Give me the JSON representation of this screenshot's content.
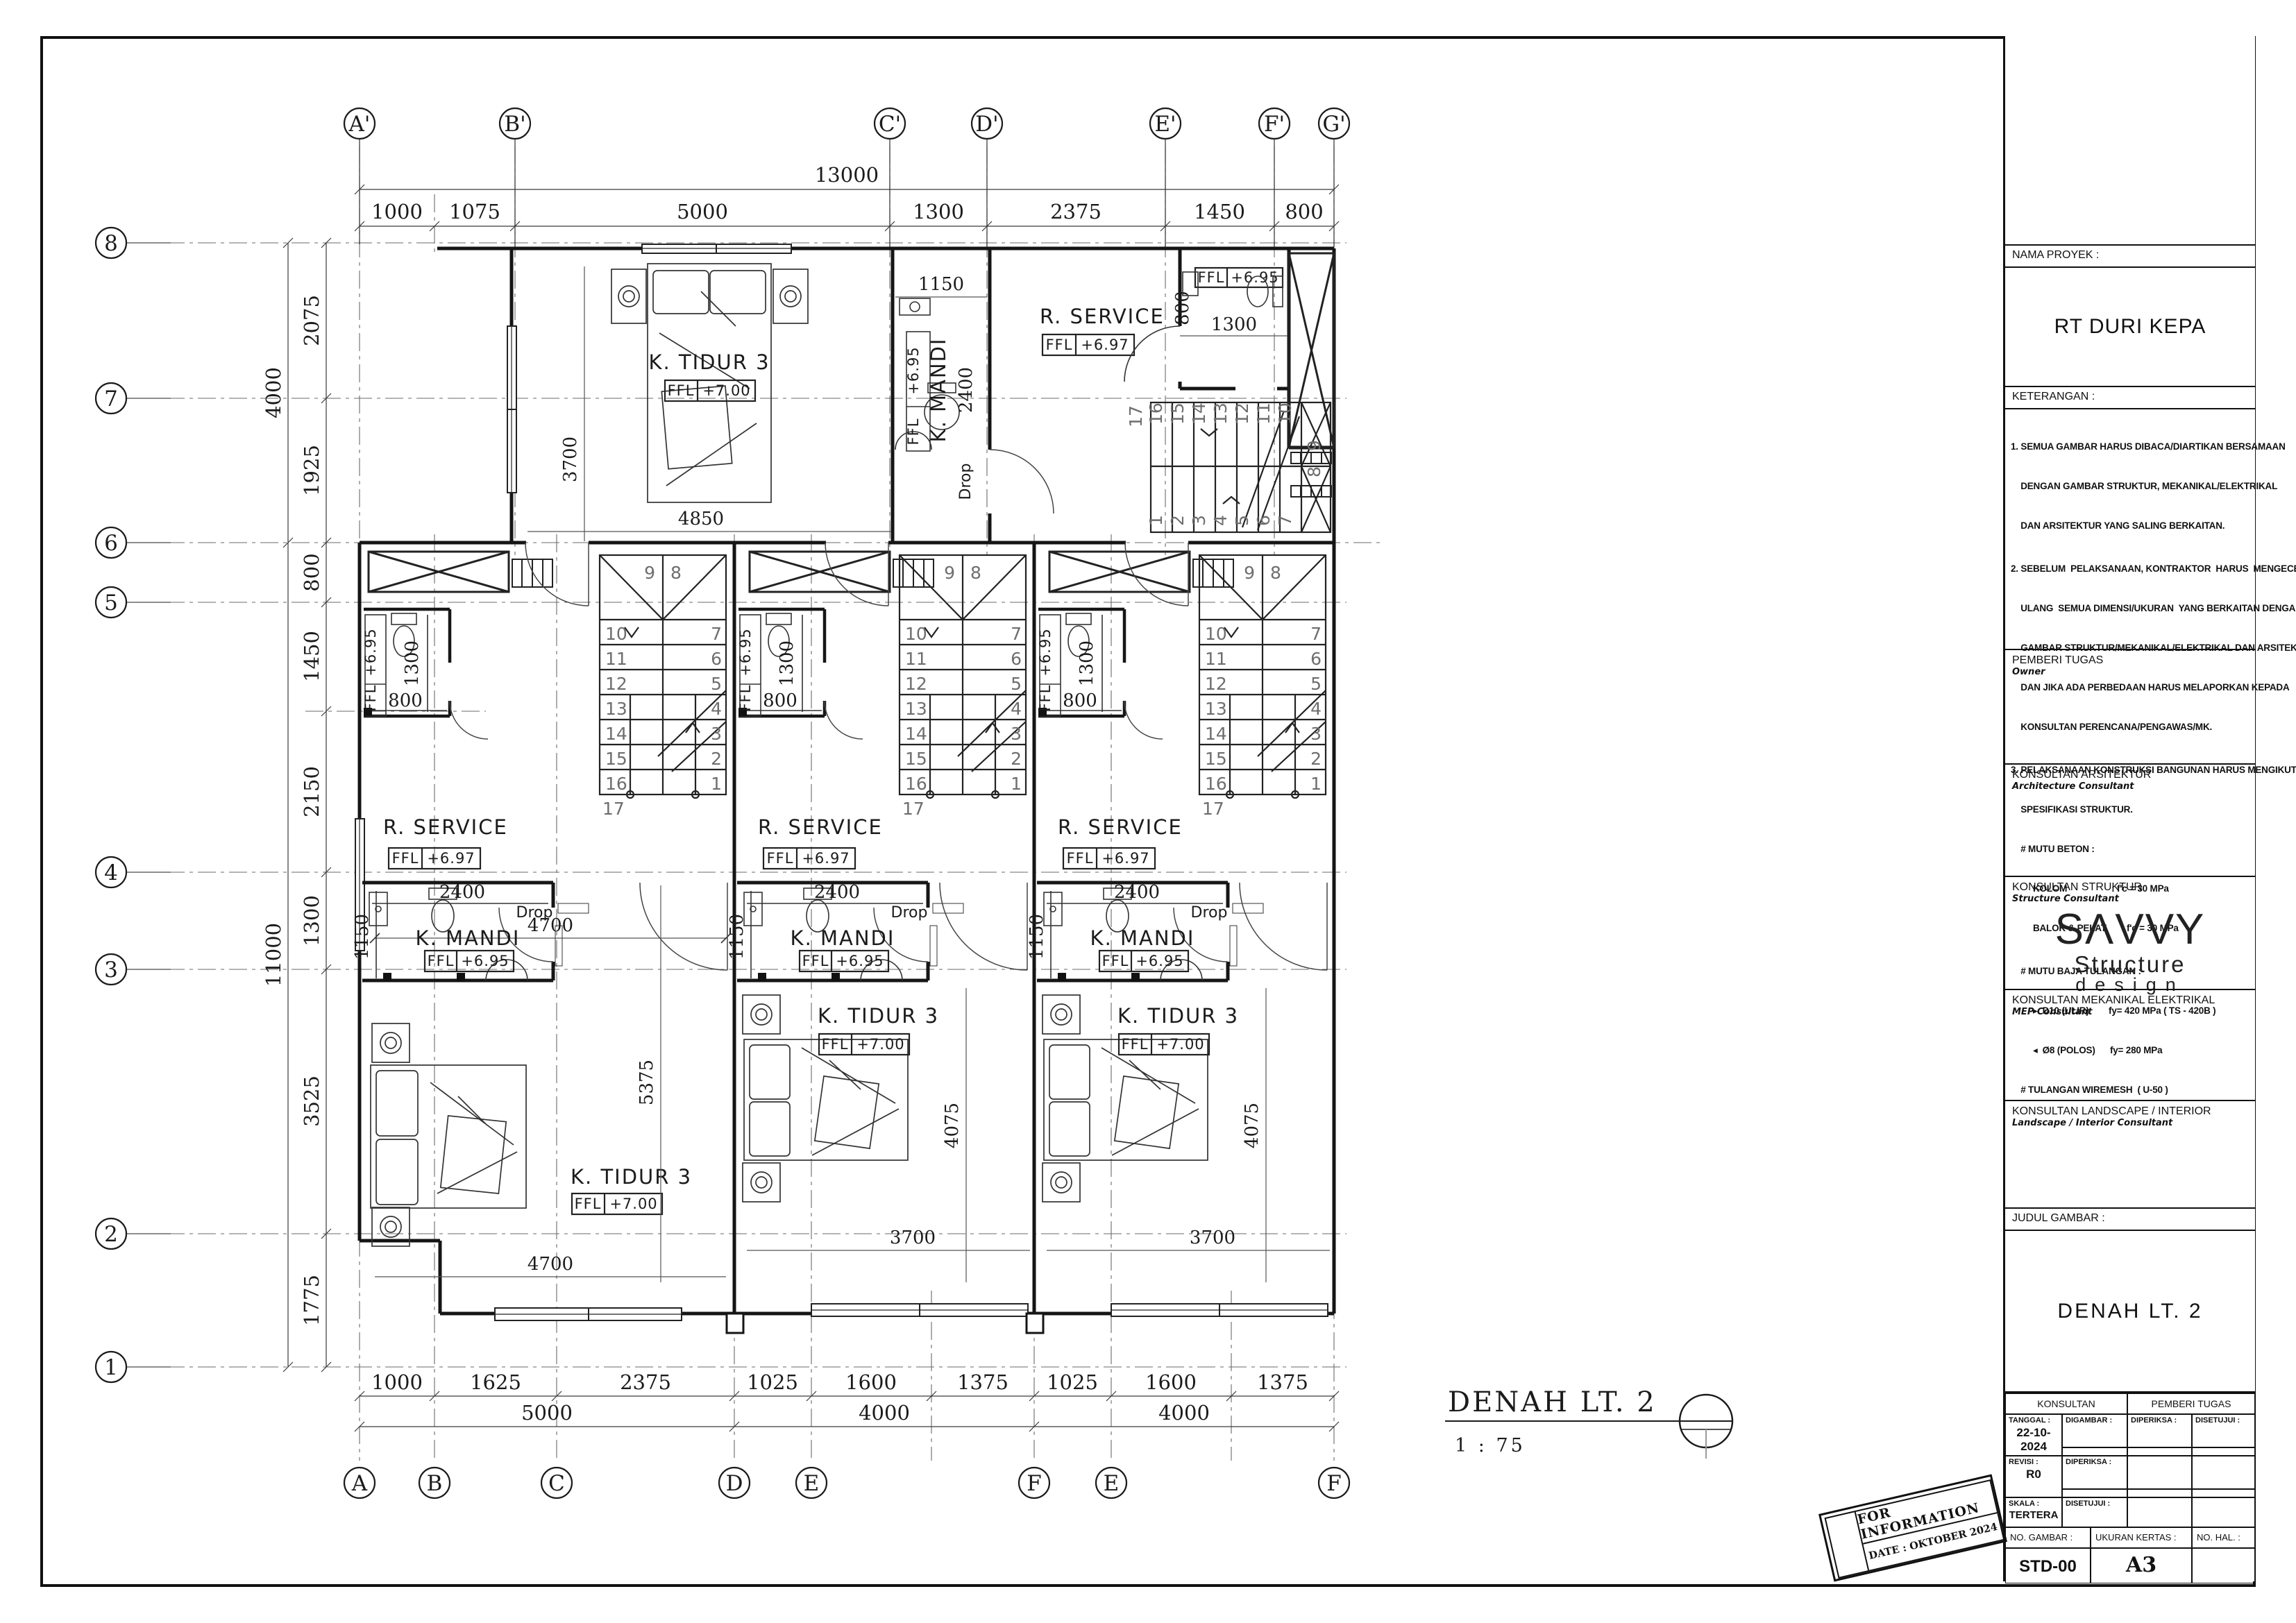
{
  "sheet": {
    "drawing_title": {
      "text": "DENAH  LT.  2",
      "scale": "1 : 75"
    },
    "stamp": {
      "line1": "FOR  INFORMATION",
      "line2": "DATE : OKTOBER 2024"
    }
  },
  "plan": {
    "grid_top": [
      "A'",
      "B'",
      "C'",
      "D'",
      "E'",
      "F'",
      "G'"
    ],
    "grid_bottom": [
      "A",
      "B",
      "C",
      "D",
      "E",
      "F",
      "E",
      "F"
    ],
    "grid_left": [
      "8",
      "7",
      "6",
      "5",
      "4",
      "3",
      "2",
      "1"
    ],
    "dims": {
      "top_total": "13000",
      "top": [
        "1000",
        "1075",
        "5000",
        "1300",
        "2375",
        "1450",
        "800"
      ],
      "left_outer": [
        "4000",
        "11000"
      ],
      "left": [
        "2075",
        "1925",
        "800",
        "1450",
        "2150",
        "1300",
        "3525",
        "1775"
      ],
      "bottom": [
        "1000",
        "1625",
        "2375",
        "1025",
        "1600",
        "1375",
        "1025",
        "1600",
        "1375"
      ],
      "bottom_totals": [
        "5000",
        "4000",
        "4000"
      ],
      "top_bed_width": "4850",
      "top_bed_depth": "3700",
      "mandi_top_width": "1150",
      "toilet_depth": "1300",
      "toilet_width": "800",
      "service_width": "4700",
      "mandi_width": "2400",
      "mandi_depth": "1150",
      "bed1_depth": "5375",
      "bed1_width": "4700",
      "bed23_depth": "4075",
      "bed23_width": "3700"
    },
    "rooms": {
      "tidur": "K. TIDUR 3",
      "mandi": "K. MANDI",
      "service": "R. SERVICE",
      "drop": "Drop"
    },
    "ffl": {
      "label": "FFL",
      "tidur": "+7.00",
      "mandi": "+6.95",
      "service": "+6.97"
    },
    "stair": {
      "landing9": "9",
      "landing8": "8",
      "last": "17",
      "upper": [
        "10",
        "11",
        "12",
        "13",
        "14",
        "15",
        "16"
      ],
      "lower": [
        "7",
        "6",
        "5",
        "4",
        "3",
        "2",
        "1"
      ]
    }
  },
  "title_block": {
    "nama_proyek_label": "NAMA PROYEK :",
    "project_name": "RT DURI KEPA",
    "keterangan_label": "KETERANGAN :",
    "notes": [
      "1. SEMUA GAMBAR HARUS DIBACA/DIARTIKAN BERSAMAAN",
      "    DENGAN GAMBAR STRUKTUR, MEKANIKAL/ELEKTRIKAL",
      "    DAN ARSITEKTUR YANG SALING BERKAITAN.",
      "2. SEBELUM  PELAKSANAAN, KONTRAKTOR  HARUS  MENGECEK",
      "    ULANG  SEMUA DIMENSI/UKURAN  YANG BERKAITAN DENGAN",
      "    GAMBAR STRUKTUR/MEKANIKAL/ELEKTRIKAL DAN ARSITEKTUR.",
      "    DAN JIKA ADA PERBEDAAN HARUS MELAPORKAN KEPADA",
      "    KONSULTAN PERENCANA/PENGAWAS/MK.",
      "3. PELAKSANAAN KONSTRUKSI BANGUNAN HARUS MENGIKUTI",
      "    SPESIFIKASI STRUKTUR.",
      "    # MUTU BETON :",
      "         KOLOM                  : f'c = 30 MPa",
      "         BALOK & PELAT      : f'c = 30 MPa",
      "    # MUTU BAJA TULANGAN :",
      "         ▸  D10 (ULIR)        fy= 420 MPa ( TS - 420B )",
      "         ◂  Ø8 (POLOS)      fy= 280 MPa",
      "    # TULANGAN WIREMESH  ( U-50 )"
    ],
    "pemberi_tugas": {
      "label": "PEMBERI TUGAS",
      "sub": "Owner"
    },
    "arsitektur": {
      "label": "KONSULTAN ARSITEKTUR",
      "sub": "Architecture  Consultant"
    },
    "struktur": {
      "label": "KONSULTAN STRUKTUR",
      "sub": "Structure  Consultant"
    },
    "logo": {
      "wordmark": "SΛVVY",
      "line2": "Structure",
      "line3": "design"
    },
    "mep": {
      "label": "KONSULTAN MEKANIKAL ELEKTRIKAL",
      "sub": "MEP  Consultant"
    },
    "landscape": {
      "label": "KONSULTAN LANDSCAPE / INTERIOR",
      "sub": "Landscape / Interior  Consultant"
    },
    "judul_label": "JUDUL GAMBAR :",
    "judul": "DENAH  LT.  2",
    "table": {
      "konsultan": "KONSULTAN",
      "pemberi_tugas": "PEMBERI TUGAS",
      "tanggal_label": "TANGGAL :",
      "tanggal": "22-10-2024",
      "digambar_label": "DIGAMBAR :",
      "diperiksa_label": "DIPERIKSA :",
      "disetujui_label": "DISETUJUI :",
      "revisi_label": "REVISI :",
      "revisi": "R0",
      "diperiksa2_label": "DIPERIKSA :",
      "skala_label": "SKALA :",
      "skala": "TERTERA",
      "disetujui2_label": "DISETUJUI :",
      "no_gambar_label": "NO. GAMBAR :",
      "no_gambar": "STD-00",
      "ukuran_kertas_label": "UKURAN KERTAS :",
      "ukuran_kertas": "A3",
      "no_hal_label": "NO. HAL. :"
    }
  }
}
